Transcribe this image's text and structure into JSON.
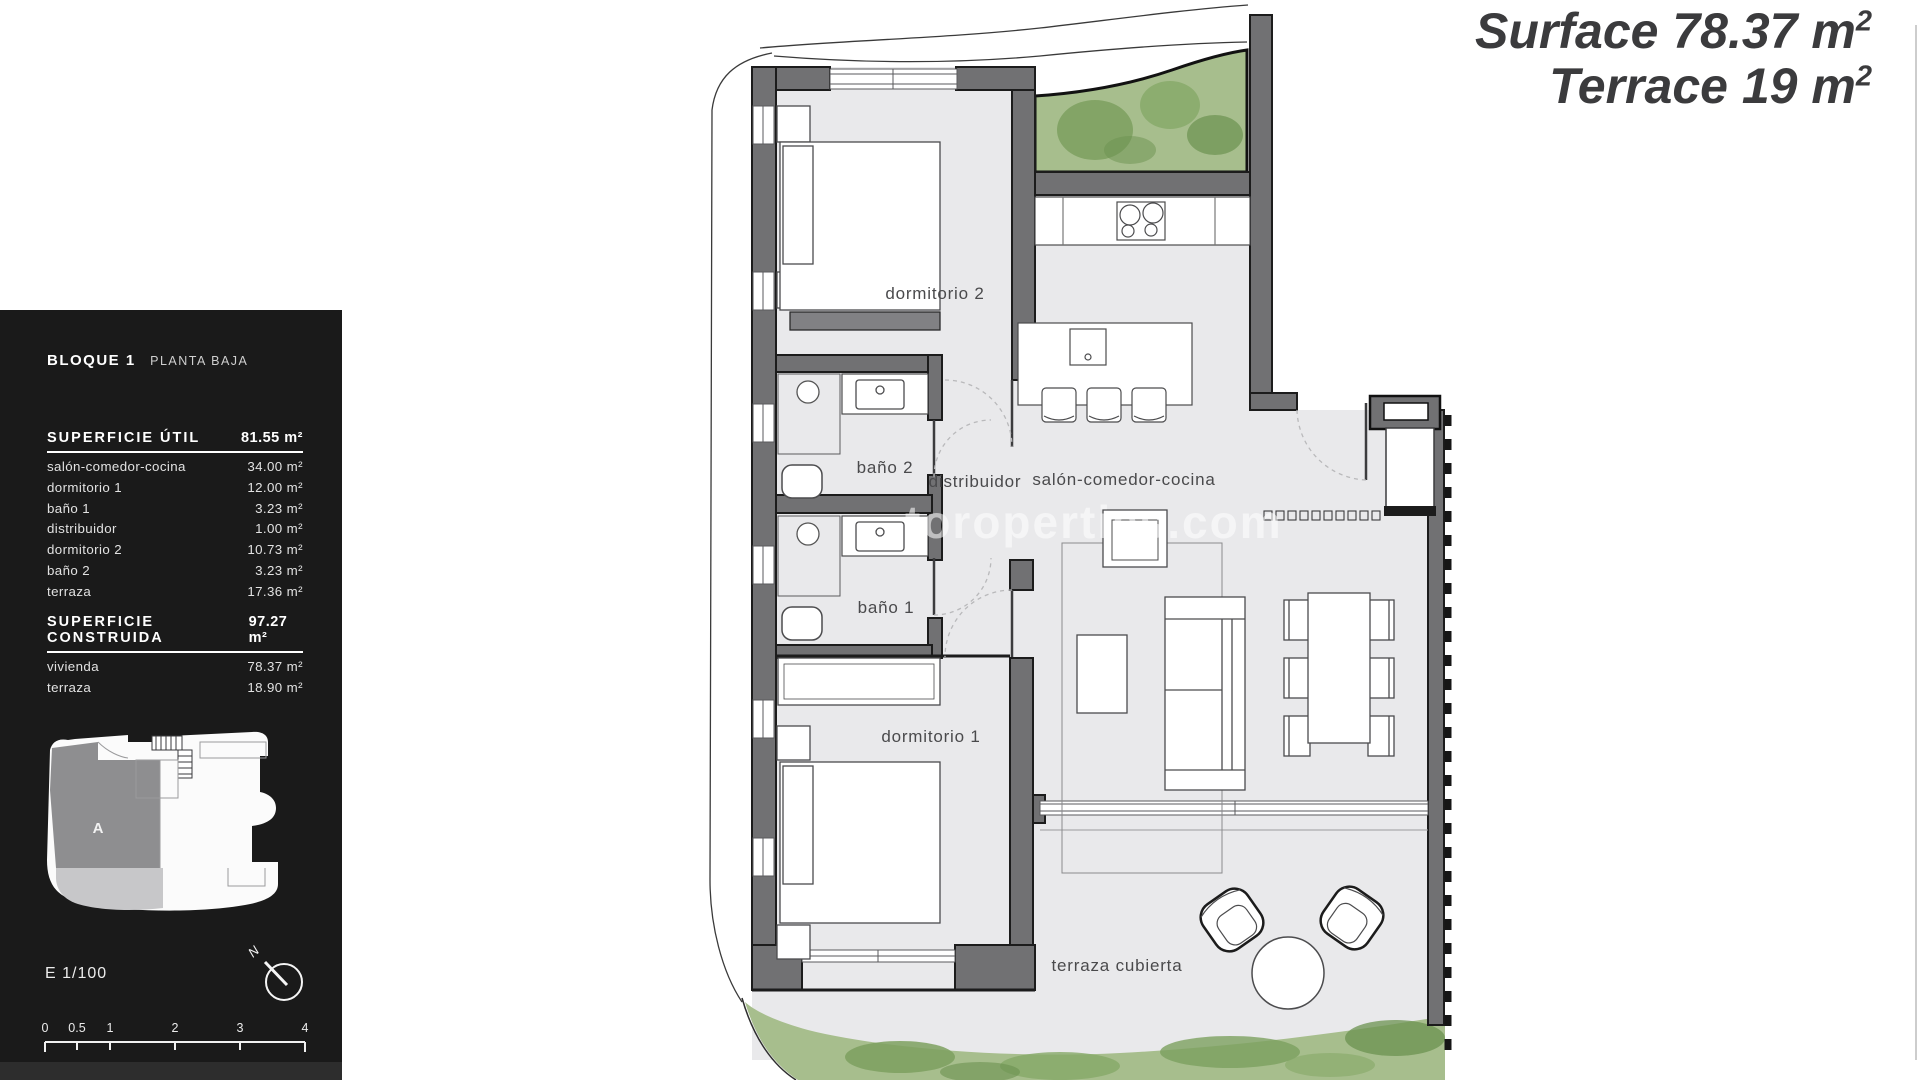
{
  "header": {
    "line1": {
      "label": "Surface",
      "value": "78.37",
      "unit": "m",
      "sup": "2"
    },
    "line2": {
      "label": "Terrace",
      "value": "19",
      "unit": "m",
      "sup": "2"
    }
  },
  "panel": {
    "block_title": "BLOQUE 1",
    "block_subtitle": "PLANTA BAJA",
    "util_header": {
      "label": "SUPERFICIE ÚTIL",
      "value": "81.55 m²"
    },
    "util_rows": [
      {
        "name": "salón-comedor-cocina",
        "value": "34.00 m²"
      },
      {
        "name": "dormitorio 1",
        "value": "12.00 m²"
      },
      {
        "name": "baño 1",
        "value": "3.23 m²"
      },
      {
        "name": "distribuidor",
        "value": "1.00 m²"
      },
      {
        "name": "dormitorio 2",
        "value": "10.73 m²"
      },
      {
        "name": "baño 2",
        "value": "3.23 m²"
      },
      {
        "name": "terraza",
        "value": "17.36 m²"
      }
    ],
    "built_header": {
      "label": "SUPERFICIE CONSTRUIDA",
      "value": "97.27 m²"
    },
    "built_rows": [
      {
        "name": "vivienda",
        "value": "78.37 m²"
      },
      {
        "name": "terraza",
        "value": "18.90 m²"
      }
    ],
    "siteplan_zone_label": "A",
    "scale_text": "E 1/100",
    "north_label": "N",
    "scalebar": [
      "0",
      "0.5",
      "1",
      "2",
      "3",
      "4"
    ]
  },
  "plan": {
    "rooms": {
      "dormitorio2": "dormitorio 2",
      "bano2": "baño 2",
      "distribuidor": "distribuidor",
      "salon": "salón-comedor-cocina",
      "bano1": "baño 1",
      "dormitorio1": "dormitorio 1",
      "terraza": "terraza cubierta"
    },
    "watermark": "toroperties.com",
    "colors": {
      "wall": "#717173",
      "floor": "#e9e9eb",
      "grass": "#a7be8d",
      "grass_dark": "#7ca05f",
      "panel": "#1a1a1a",
      "title_text": "#3b3b3d"
    }
  }
}
